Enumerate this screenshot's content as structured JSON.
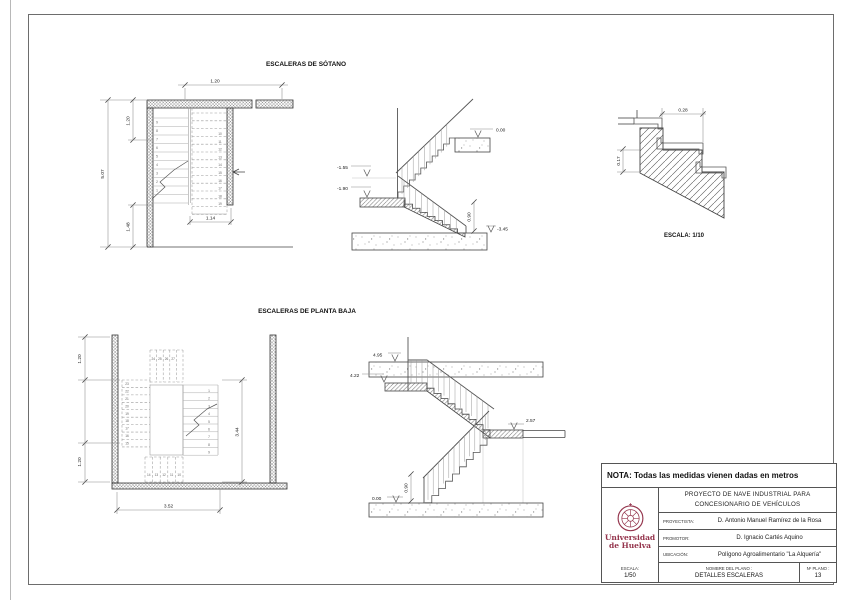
{
  "page": {
    "note": "NOTA: Todas las medidas vienen dadas en metros"
  },
  "sotano": {
    "title": "ESCALERAS DE SÓTANO",
    "plan": {
      "dim_top": "1.20",
      "dim_total": "5.07",
      "dim_upper": "1.20",
      "dim_lower": "1.48",
      "dim_flight": "1.14",
      "left_steps": [
        "9",
        "8",
        "7",
        "6",
        "5",
        "4",
        "3",
        "2",
        "1"
      ],
      "right_steps": [
        "10",
        "11",
        "12",
        "13",
        "14",
        "15",
        "16",
        "17",
        "18",
        "19"
      ]
    },
    "section": {
      "lvl_top": "0.00",
      "lvl_mid1": "-1.55",
      "lvl_mid2": "-1.90",
      "lvl_bottom": "-3.45",
      "rail": "0.90"
    },
    "detail": {
      "tread": "0.28",
      "riser": "0.17",
      "scale": "ESCALA: 1/10"
    }
  },
  "baja": {
    "title": "ESCALERAS DE PLANTA BAJA",
    "plan": {
      "dim_left_up": "1.20",
      "dim_left_low": "1.20",
      "dim_bottom": "3.52",
      "dim_right": "3.44",
      "right_steps": [
        "1",
        "2",
        "3",
        "4",
        "5",
        "6",
        "7",
        "8",
        "9"
      ],
      "left_steps": [
        "23",
        "22",
        "21",
        "20",
        "19",
        "18",
        "17",
        "16",
        "15"
      ],
      "top_steps": [
        "24",
        "25",
        "26",
        "27"
      ],
      "bottom_steps": [
        "14",
        "13",
        "12",
        "11",
        "10"
      ]
    },
    "section": {
      "lvl_top": "4.95",
      "lvl_land": "4.22",
      "lvl_mid": "2.57",
      "lvl_bottom": "0.00",
      "rail": "0.90"
    }
  },
  "titleblock": {
    "project_line1": "PROYECTO DE NAVE INDUSTRIAL PARA",
    "project_line2": "CONCESIONARIO DE VEHÍCULOS",
    "rows": [
      {
        "label": "PROYECTISTA:",
        "value": "D. Antonio Manuel Ramírez de la Rosa"
      },
      {
        "label": "PROMOTOR:",
        "value": "D. Ignacio Cartés Aquino"
      },
      {
        "label": "UBICACIÓN:",
        "value": "Polígono Agroalimentario \"La Alquería\""
      }
    ],
    "escala_label": "ESCALA:",
    "escala_value": "1/50",
    "nombre_label": "NOMBRE DEL PLANO :",
    "nombre_value": "DETALLES ESCALERAS",
    "nplano_label": "Nº PLANO :",
    "nplano_value": "13",
    "logo_line1": "Universidad",
    "logo_line2": "de Huelva",
    "logo_color": "#94344c"
  }
}
